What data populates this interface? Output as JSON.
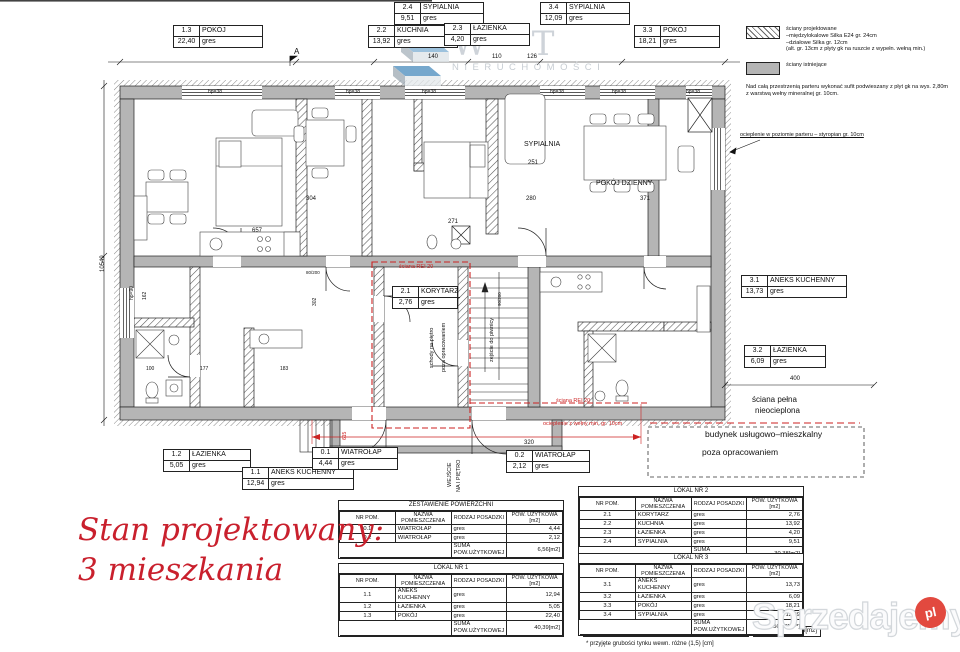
{
  "stamp": {
    "line1": "Stan projektowany:",
    "line2": "3 mieszkania",
    "color": "#c9202d"
  },
  "legend": {
    "items": [
      {
        "swatch": "hatch",
        "lines": [
          "ściany projektowane",
          "–międzylokalowe Silka E24 gr. 24cm",
          "–działowe Silka gr. 12cm",
          "(alt. gr. 13cm z płyty gk na ruszcie z wypełn. wełną min.)"
        ]
      },
      {
        "swatch": "solid",
        "lines": [
          "ściany istniejące"
        ]
      }
    ],
    "note": "Nad całą przestrzenią parteru wykonać  sufit podwieszany z płyt gk na wys. 2,80m z warstwą wełny mineralnej gr. 10cm."
  },
  "plan": {
    "rooms": [
      {
        "id": "1.3",
        "name": "POKÓJ",
        "area": "22,40",
        "floor": "gres",
        "x": 173,
        "y": 25,
        "w": 88
      },
      {
        "id": "2.2",
        "name": "KUCHNIA",
        "area": "13,92",
        "floor": "gres",
        "x": 368,
        "y": 25,
        "w": 88
      },
      {
        "id": "2.4",
        "name": "SYPIALNIA",
        "area": "9,51",
        "floor": "gres",
        "x": 394,
        "y": 2,
        "w": 88
      },
      {
        "id": "3.4",
        "name": "SYPIALNIA",
        "area": "12,09",
        "floor": "gres",
        "x": 540,
        "y": 2,
        "w": 88
      },
      {
        "id": "2.3",
        "name": "ŁAZIENKA",
        "area": "4,20",
        "floor": "gres",
        "x": 444,
        "y": 23,
        "w": 84
      },
      {
        "id": "3.3",
        "name": "POKÓJ",
        "area": "18,21",
        "floor": "gres",
        "x": 634,
        "y": 25,
        "w": 84
      },
      {
        "id": "2.1",
        "name": "KORYTARZ",
        "area": "2,76",
        "floor": "gres",
        "x": 392,
        "y": 286,
        "w": 64
      },
      {
        "id": "3.1",
        "name": "ANEKS KUCHENNY",
        "area": "13,73",
        "floor": "gres",
        "x": 741,
        "y": 275,
        "w": 104
      },
      {
        "id": "3.2",
        "name": "ŁAZIENKA",
        "area": "6,09",
        "floor": "gres",
        "x": 744,
        "y": 345,
        "w": 80
      },
      {
        "id": "1.2",
        "name": "ŁAZIENKA",
        "area": "5,05",
        "floor": "gres",
        "x": 163,
        "y": 449,
        "w": 86
      },
      {
        "id": "1.1",
        "name": "ANEKS KUCHENNY",
        "area": "12,94",
        "floor": "gres",
        "x": 242,
        "y": 467,
        "w": 110
      },
      {
        "id": "0.1",
        "name": "WIATROŁAP",
        "area": "4,44",
        "floor": "gres",
        "x": 312,
        "y": 447,
        "w": 84
      },
      {
        "id": "0.2",
        "name": "WIATROŁAP",
        "area": "2,12",
        "floor": "gres",
        "x": 506,
        "y": 450,
        "w": 82
      }
    ],
    "dims": [
      {
        "t": "140",
        "x": 428,
        "y": 54
      },
      {
        "t": "110",
        "x": 492,
        "y": 54
      },
      {
        "t": "126",
        "x": 527,
        "y": 54
      },
      {
        "t": "hp=38",
        "x": 208,
        "y": 89,
        "s": 5
      },
      {
        "t": "hp=38",
        "x": 346,
        "y": 89,
        "s": 5
      },
      {
        "t": "hp=38",
        "x": 422,
        "y": 89,
        "s": 5
      },
      {
        "t": "hp=38",
        "x": 550,
        "y": 89,
        "s": 5
      },
      {
        "t": "hp=38",
        "x": 612,
        "y": 89,
        "s": 5
      },
      {
        "t": "hp=38",
        "x": 686,
        "y": 89,
        "s": 5
      },
      {
        "t": "10549",
        "x": 100,
        "y": 272,
        "r": -90
      },
      {
        "t": "hp=90",
        "x": 129,
        "y": 300,
        "r": -90,
        "s": 5
      },
      {
        "t": "657",
        "x": 252,
        "y": 228
      },
      {
        "t": "304",
        "x": 306,
        "y": 196
      },
      {
        "t": "271",
        "x": 448,
        "y": 219
      },
      {
        "t": "251",
        "x": 528,
        "y": 160
      },
      {
        "t": "280",
        "x": 526,
        "y": 196
      },
      {
        "t": "371",
        "x": 640,
        "y": 196
      },
      {
        "t": "100",
        "x": 146,
        "y": 366,
        "s": 5
      },
      {
        "t": "177",
        "x": 200,
        "y": 366,
        "s": 5
      },
      {
        "t": "183",
        "x": 280,
        "y": 366,
        "s": 5
      },
      {
        "t": "302",
        "x": 312,
        "y": 306,
        "r": -90,
        "s": 5
      },
      {
        "t": "162",
        "x": 142,
        "y": 300,
        "r": -90,
        "s": 5
      },
      {
        "t": "400",
        "x": 790,
        "y": 376
      },
      {
        "t": "320",
        "x": 524,
        "y": 440
      },
      {
        "t": "615",
        "x": 342,
        "y": 440,
        "r": -90,
        "red": true,
        "s": 5
      },
      {
        "t": "80/200",
        "x": 306,
        "y": 270,
        "s": 4.5
      },
      {
        "t": "90/200",
        "x": 497,
        "y": 306,
        "r": -90,
        "s": 4.5
      },
      {
        "t": "A",
        "x": 294,
        "y": 49,
        "s": 8
      }
    ],
    "notes": [
      {
        "t": "SYPIALNIA",
        "x": 524,
        "y": 142,
        "s": 7
      },
      {
        "t": "POKÓJ DZIENNY",
        "x": 596,
        "y": 181,
        "s": 7
      },
      {
        "t": "schody na piętro",
        "x": 429,
        "y": 368,
        "r": -90,
        "s": 5.5
      },
      {
        "t": "poza opracowaniem",
        "x": 441,
        "y": 372,
        "r": -90,
        "s": 5.5
      },
      {
        "t": "zejście do piwnicy",
        "x": 489,
        "y": 362,
        "r": -90,
        "s": 5.5
      },
      {
        "t": "WEJŚCIE",
        "x": 447,
        "y": 487,
        "r": -90,
        "s": 5.5
      },
      {
        "t": "NA I PIĘTRO",
        "x": 456,
        "y": 492,
        "r": -90,
        "s": 5.5
      },
      {
        "t": "ściana pełna",
        "x": 752,
        "y": 397,
        "s": 8,
        "big": true
      },
      {
        "t": "nieocieplona",
        "x": 755,
        "y": 408,
        "s": 8,
        "big": true
      },
      {
        "t": "budynek usługowo–mieszkalny",
        "x": 705,
        "y": 431,
        "s": 8.5,
        "big": true
      },
      {
        "t": "poza opracowaniem",
        "x": 702,
        "y": 449,
        "s": 8.5,
        "big": true
      },
      {
        "t": "ocieplenie w poziomie parteru – styropian gr. 10cm",
        "x": 740,
        "y": 132,
        "s": 5.5,
        "u": 1
      }
    ],
    "red_notes": [
      {
        "t": "ściana REI 20",
        "x": 399,
        "y": 264,
        "s": 5.5
      },
      {
        "t": "ściana REI 20",
        "x": 556,
        "y": 398,
        "s": 5.5
      },
      {
        "t": "ocieplenie z wełny min. gr. 10cm",
        "x": 543,
        "y": 421,
        "s": 5.5
      }
    ]
  },
  "tables": {
    "columns": [
      "NR POM.",
      "NAZWA POMIESZCZENIA",
      "RODZAJ POSADZKI",
      "POW. UŻYTKOWA\n[m2]"
    ],
    "list": [
      {
        "title": "ZESTAWIENIE POWIERZCHNI",
        "x": 338,
        "y": 500,
        "rows": [
          [
            "0.1",
            "WIATROŁAP",
            "gres",
            "4,44"
          ],
          [
            "0.2",
            "WIATROŁAP",
            "gres",
            "2,12"
          ]
        ],
        "sum_label": "SUMA POW.UŻYTKOWEJ",
        "sum": "6,56[m2]"
      },
      {
        "title": "LOKAL NR 1",
        "x": 338,
        "y": 563,
        "rows": [
          [
            "1.1",
            "ANEKS KUCHENNY",
            "gres",
            "12,94"
          ],
          [
            "1.2",
            "ŁAZIENKA",
            "gres",
            "5,05"
          ],
          [
            "1.3",
            "POKÓJ",
            "gres",
            "22,40"
          ]
        ],
        "sum_label": "SUMA POW.UŻYTKOWEJ",
        "sum": "40,39[m2]"
      },
      {
        "title": "LOKAL NR 2",
        "x": 578,
        "y": 486,
        "rows": [
          [
            "2.1",
            "KORYTARZ",
            "gres",
            "2,76"
          ],
          [
            "2.2",
            "KUCHNIA",
            "gres",
            "13,92"
          ],
          [
            "2.3",
            "ŁAZIENKA",
            "gres",
            "4,20"
          ],
          [
            "2.4",
            "SYPIALNIA",
            "gres",
            "9,51"
          ]
        ],
        "sum_label": "SUMA POW.UŻYTKOWEJ",
        "sum": "30,38[m2]"
      },
      {
        "title": "LOKAL NR 3",
        "x": 578,
        "y": 553,
        "rows": [
          [
            "3.1",
            "ANEKS KUCHENNY",
            "gres",
            "13,73"
          ],
          [
            "3.2",
            "ŁAZIENKA",
            "gres",
            "6,09"
          ],
          [
            "3.3",
            "POKÓJ",
            "gres",
            "18,21"
          ],
          [
            "3.4",
            "SYPIALNIA",
            "gres",
            "12,09"
          ]
        ],
        "sum_label": "SUMA POW.UŻYTKOWEJ",
        "sum": "50,12[m²*]"
      }
    ],
    "grand": {
      "label": "SUMA POW.UŻYTKOWEJ",
      "value": "127,45[m2]",
      "x": 583,
      "y": 626
    },
    "footnote": {
      "text": "* przyjęte grubości tynku wewn. różne (1,5) [cm]",
      "x": 586,
      "y": 641
    }
  },
  "watermarks": {
    "letters": "W T",
    "subtitle": "NIERUCHOMOŚCI",
    "brand": "Sprzedajemy",
    "tld": "pl"
  }
}
